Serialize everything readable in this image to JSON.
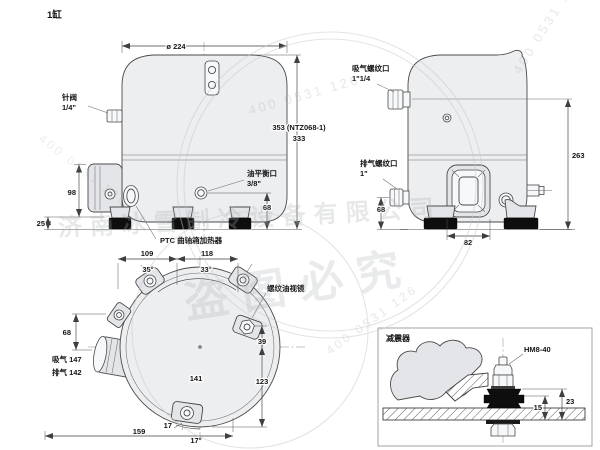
{
  "title": "1缸",
  "front": {
    "dia": "ø 224",
    "needle1": "针阀",
    "needle2": "1/4\"",
    "h1": "353 (NTZ068-1)",
    "h2": "333",
    "oil1": "油平衡口",
    "oil2": "3/8\"",
    "d98": "98",
    "d25": "25",
    "d68": "68",
    "ptc": "PTC 曲轴箱加热器"
  },
  "side": {
    "suc1": "吸气螺纹口",
    "suc2": "1\"1/4",
    "dis1": "排气螺纹口",
    "dis2": "1\"",
    "d263": "263",
    "d82": "82",
    "d68": "68"
  },
  "top": {
    "d109": "109",
    "d118": "118",
    "a35": "35°",
    "a33": "33°",
    "sight": "螺纹油视镜",
    "d39": "39",
    "d123": "123",
    "d68": "68",
    "suc": "吸气 147",
    "dis": "排气 142",
    "d141": "141",
    "d159": "159",
    "d17": "17",
    "a17": "17°"
  },
  "detail": {
    "title": "减震器",
    "bolt": "HM8-40",
    "d15": "15",
    "d23": "23"
  },
  "watermarks": {
    "company": "济南冰雪制冷设备有限公司",
    "warning": "盗图必究",
    "phone": "400 0531 126"
  }
}
